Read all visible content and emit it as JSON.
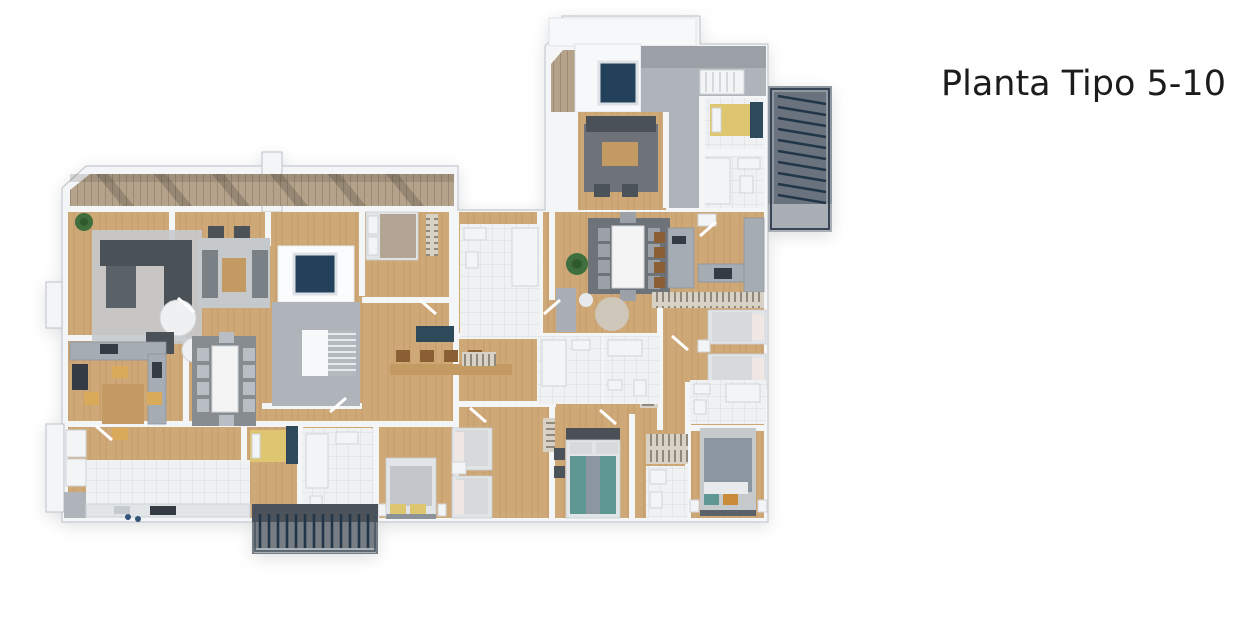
{
  "header": {
    "title": "Planta Tipo 5-10"
  },
  "palette": {
    "bg": "#ffffff",
    "ink": "#1c1c1e",
    "wall_inner": "#f3f5f7",
    "wall_edge": "#c5cad0",
    "wood": "#cfa878",
    "wood_line": "#b98f5e",
    "deck": "#b5a28b",
    "deck_line": "#9c8a73",
    "tile": "#eff1f3",
    "tile_line": "#d8dce0",
    "stone": "#aeb4ba",
    "stone_dark": "#8f969d",
    "pool": "#24415c",
    "louver": "#223649",
    "rug": "#c5c9cc",
    "rug_dark": "#6d7378",
    "sofa": "#4a5157",
    "marble": "#f4f4f4",
    "bed_white": "#e2e5e7",
    "yellow": "#ddc66f",
    "teal": "#5f9793",
    "orange": "#c98a3a",
    "plant": "#3f6f3c",
    "wood_furn": "#c39a62",
    "stool": "#8a5f33",
    "counter": "#a6acb3",
    "appliance": "#343b44"
  },
  "floorplan": {
    "kind": "3d-rendered-typical-floor-plan",
    "features": [
      "terrace-pergola-deck",
      "penthouse-roof",
      "plunge-pool",
      "stone-terrace",
      "exterior-stair-opening",
      "louver-balcony-right",
      "louver-balcony-bottom",
      "central-stairwell",
      "stairwell-skylight",
      "living-room-left",
      "living-room-center",
      "penthouse-living-room",
      "dining-table-marble",
      "dining-table-white",
      "dining-table-wood",
      "kitchen-left",
      "kitchen-right",
      "kitchen-island",
      "breakfast-bar",
      "bedroom-yellow-penthouse",
      "bedroom-yellow-left",
      "bedroom-double-left",
      "bedroom-twin-center",
      "bedroom-double-teal",
      "bedroom-twin-right",
      "bedroom-double-right",
      "tiled-bathrooms",
      "closets-with-hangers",
      "indoor-plants",
      "laundry-counter",
      "entry-stone-floor"
    ]
  }
}
